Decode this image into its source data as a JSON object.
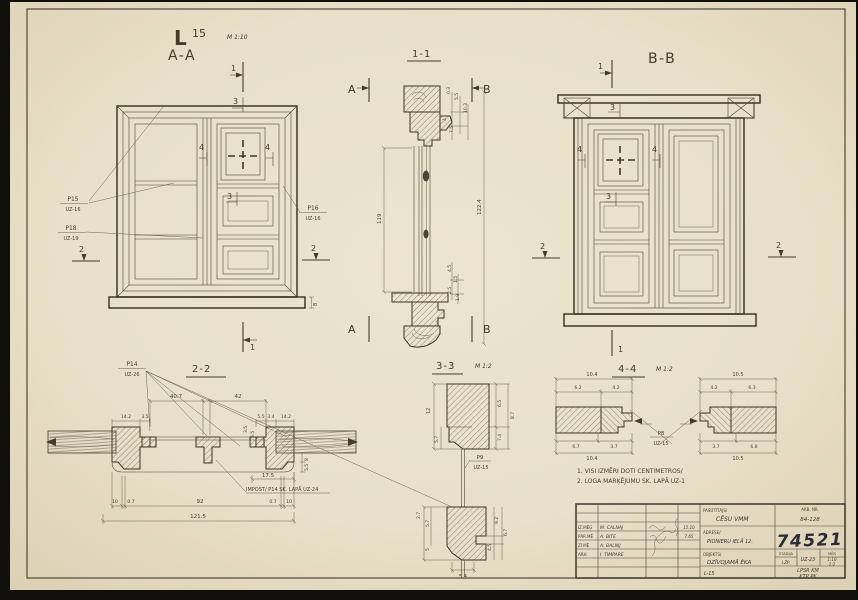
{
  "sheet": {
    "code": "L",
    "index": "15",
    "scale": "M 1:10"
  },
  "views": {
    "aa": "A-A",
    "bb": "B-B",
    "s11": "1-1",
    "s22": "2-2",
    "s33": "3-3",
    "s44": "4-4",
    "detail_scale": "M 1:2"
  },
  "marks": {
    "n1": "1",
    "n2": "2",
    "n3": "3",
    "n4": "4",
    "A": "A",
    "B": "B"
  },
  "callouts": {
    "p15c": "P15",
    "p15r": "UZ-16",
    "p18c": "P18",
    "p18r": "UZ-19",
    "p16c": "P16",
    "p16r": "UZ-16",
    "p14c": "P14",
    "p14r": "UZ-26",
    "p9c": "P9",
    "p9r": "UZ-15",
    "p8c": "P8",
    "p8r": "UZ-15",
    "impost": "IMPOST/ P14 SK. LAPĀ UZ-24"
  },
  "dims": {
    "aa": {
      "sill": "8"
    },
    "s11": {
      "hl": "119",
      "hr": "122.4",
      "t0": "0.3",
      "t1": "5.5",
      "t2": "10.3",
      "t3": "4",
      "t4": "7.5",
      "b0": "4.5",
      "b1": "1.5",
      "b2": "2.5",
      "b3": "1.9",
      "b4": "4"
    },
    "s22": {
      "l": "40.7",
      "r": "42",
      "jl0": "14.2",
      "jl1": "3.5",
      "jr0": "5.5",
      "jr1": "3.4",
      "jr2": "14.2",
      "rot0": "3.5",
      "rot1": "5.5",
      "e0": "8",
      "e1": "5.5",
      "d": "17.5",
      "b0": "10",
      "b1": "0.7",
      "b2": "92",
      "b3": "0.7",
      "b4": "10",
      "total": "121.5"
    },
    "s33": {
      "ul0": "12",
      "ul1": "5.7",
      "ur0": "6.5",
      "ur1": "7.4",
      "ur2": "8.7",
      "ll0": "2.7",
      "ll1": "5.7",
      "ll2": "5",
      "lr0": "9.2",
      "lr1": "4.5",
      "lr2": "6.7",
      "lb": "5.4"
    },
    "s44": {
      "lt": "10.4",
      "lt0": "6.2",
      "lt1": "4.2",
      "lb0": "6.7",
      "lb1": "3.7",
      "lb": "10.4",
      "rt": "10.5",
      "rt0": "4.2",
      "rt1": "6.3",
      "rb0": "3.7",
      "rb1": "6.8",
      "rb": "10.5"
    }
  },
  "notes": {
    "n1": "1. VISI IZMĒRI DOTI CENTIMETROS/",
    "n2": "2. LOGA MARĶĒJUMU SK. LAPĀ UZ-1"
  },
  "titleblock": {
    "r0role": "IZ.MĒĢ",
    "r0name": "M. CALNAJ",
    "r0date": "15.10",
    "r1role": "PĀR.MĒ",
    "r1name": "A. BITE",
    "r1date": "7.65",
    "r2role": "ZĪ.MĒ",
    "r2name": "A. BALNIJ",
    "r3role": "ARH.",
    "r3name": "I. TIMPARE",
    "client_label": "PASŪTĪTĀJS/",
    "client": "CĒSU VMM",
    "address_label": "ADRESE/",
    "address": "PIONIERU IELĀ 12.",
    "object_label": "OBJEKTS/",
    "object": "DZĪVOJAMĀ ĒKA",
    "job_label": "ARB. NR.",
    "job": "84-128",
    "number": "74521",
    "stage_label": "STADIJA",
    "stage": "I.ZP.",
    "sheet_ref": "UZ-23",
    "scale_label": "MĒR",
    "scale1": "1:10",
    "scale2": "1:2",
    "sheet_no": "L-15",
    "org1": "LPSR KM",
    "org2": "KTP PK"
  }
}
